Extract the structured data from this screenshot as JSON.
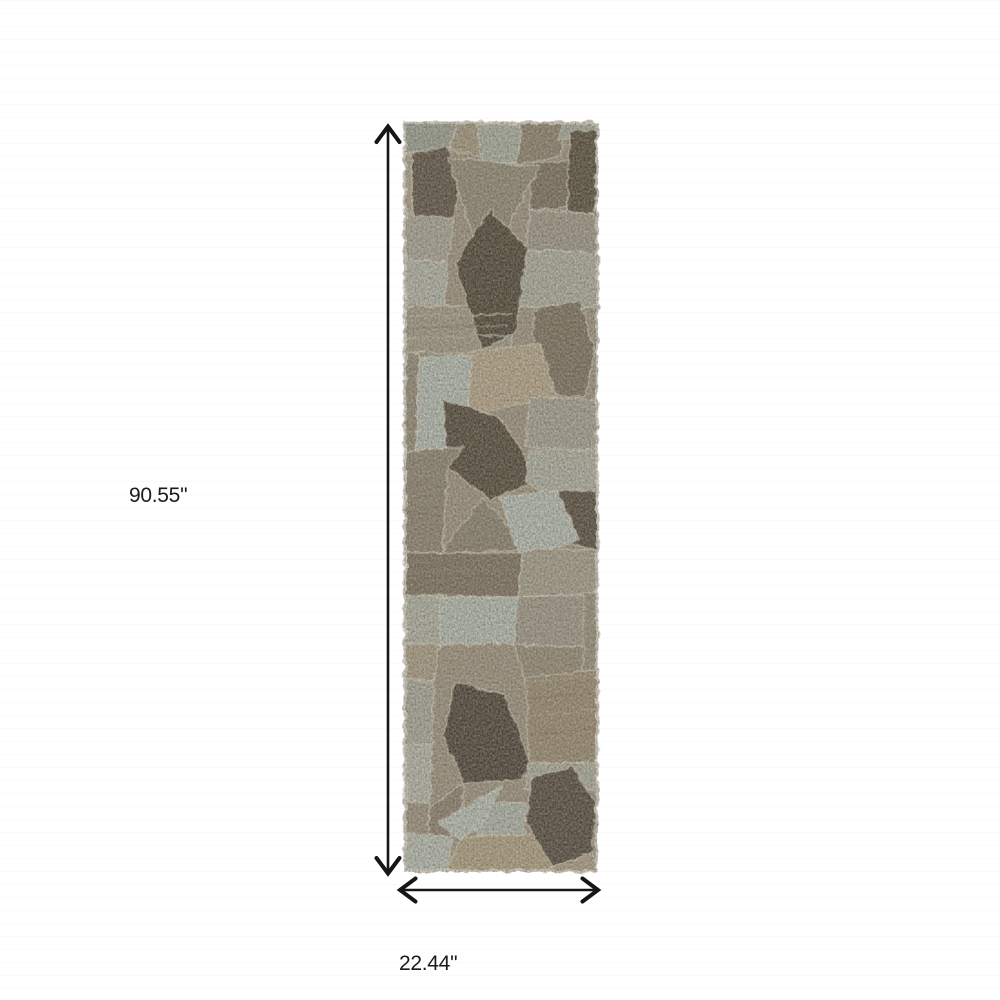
{
  "page": {
    "background_color": "#ffffff"
  },
  "dimensions": {
    "height_label": "90.55''",
    "width_label": "22.44''",
    "arrow_color": "#161616",
    "label_color": "#1b1b1b"
  },
  "rug": {
    "x": 404,
    "y": 122,
    "width": 194,
    "height": 750,
    "base_color": "#9d9381",
    "seam_color": "#d8d2c1",
    "edge_color": "#d3cec3",
    "palette": {
      "sage": "#b3bcb3",
      "taupe": "#a1987f",
      "gray": "#9c9889",
      "tan": "#b4a68c",
      "brown": "#7c7260",
      "dark_brown": "#4f4839"
    },
    "shapes": [
      {
        "points": "0,0 54,0 46,26 0,32",
        "fill": "#99a094"
      },
      {
        "points": "46,26 54,0 122,0 118,42 50,30",
        "fill": "#a1987f"
      },
      {
        "points": "74,2 118,2 115,40 77,44",
        "fill": "#a7aea1"
      },
      {
        "points": "118,0 162,0 157,34 114,42",
        "fill": "#8d8270"
      },
      {
        "points": "157,0 194,0 194,16 155,18",
        "fill": "#a3aa9d"
      },
      {
        "points": "129,41 166,38 163,85 126,88",
        "fill": "#7b7160"
      },
      {
        "points": "166,10 193,8 191,92 163,90",
        "fill": "#57503f"
      },
      {
        "points": "8,32 42,24 56,48 50,96 22,112 8,88",
        "fill": "#5d5547"
      },
      {
        "points": "0,32 8,32 8,88 22,112 18,150 0,148",
        "fill": "#a89f8c"
      },
      {
        "points": "0,92 50,96 44,140 0,138",
        "fill": "#a7a496"
      },
      {
        "points": "0,138 44,140 40,186 0,184",
        "fill": "#b0b3a8"
      },
      {
        "points": "44,35 136,45 79,148",
        "fill": "#8f8a77"
      },
      {
        "points": "126,88 191,92 194,132 121,128",
        "fill": "#9c9889"
      },
      {
        "points": "121,128 194,132 194,186 112,184",
        "fill": "#aaad9f"
      },
      {
        "points": "0,184 112,184 106,232 0,230",
        "fill": "#9f9988"
      },
      {
        "points": "86,88 123,126 112,210 78,228 51,140",
        "fill": "#4f4839"
      },
      {
        "points": "0,230 16,232 12,328 0,330",
        "fill": "#928a79"
      },
      {
        "points": "129,188 176,178 191,228 181,275 131,272",
        "fill": "#7c7260"
      },
      {
        "points": "53,231 136,222 152,275 66,293",
        "fill": "#b4a68c"
      },
      {
        "points": "16,235 68,233 60,325 12,328",
        "fill": "#b3bcb3"
      },
      {
        "points": "126,275 194,278 194,328 121,325",
        "fill": "#a4a193"
      },
      {
        "points": "39,278 96,296 136,358 86,378 44,345",
        "fill": "#534b3c"
      },
      {
        "points": "126,328 194,328 194,370 139,370 121,360",
        "fill": "#adb0a3"
      },
      {
        "points": "0,330 60,325 44,345 38,431 0,431",
        "fill": "#8c8373"
      },
      {
        "points": "139,368 194,368 194,428 160,421",
        "fill": "#584f41"
      },
      {
        "points": "79,376 126,428 36,431",
        "fill": "#8b8270"
      },
      {
        "points": "96,375 153,368 176,418 116,438",
        "fill": "#b4bdb5"
      },
      {
        "points": "0,431 119,431 114,475 0,473",
        "fill": "#7d7363"
      },
      {
        "points": "119,428 194,428 194,471 114,475",
        "fill": "#a49e8d"
      },
      {
        "points": "36,475 119,475 114,521 36,523",
        "fill": "#b2bbb2"
      },
      {
        "points": "114,475 183,473 180,525 110,523",
        "fill": "#9d998a"
      },
      {
        "points": "180,471 194,471 194,548 178,548",
        "fill": "#97907e"
      },
      {
        "points": "0,473 36,475 36,523 0,521",
        "fill": "#aeb1a4"
      },
      {
        "points": "0,521 36,523 30,558 0,558",
        "fill": "#a89d87"
      },
      {
        "points": "110,523 180,525 178,560 121,558",
        "fill": "#958c78"
      },
      {
        "points": "121,556 194,548 194,641 126,641",
        "fill": "#998c74"
      },
      {
        "points": "0,558 30,558 28,622 0,622",
        "fill": "#a5a89b"
      },
      {
        "points": "0,622 28,622 26,680 0,680",
        "fill": "#b3b6ab"
      },
      {
        "points": "50,560 100,572 126,640 118,658 60,661 40,615",
        "fill": "#4c453a"
      },
      {
        "points": "126,641 194,641 194,668 120,666",
        "fill": "#a9ac9e"
      },
      {
        "points": "75,682 122,680 120,712 73,714",
        "fill": "#adb4aa"
      },
      {
        "points": "0,680 26,680 24,714 0,714",
        "fill": "#9c9180"
      },
      {
        "points": "26,685 60,661 56,714 24,714",
        "fill": "#8a8070"
      },
      {
        "points": "34,700 98,664 78,704 56,718",
        "fill": "#b6bfb6"
      },
      {
        "points": "0,712 48,714 45,748 0,748",
        "fill": "#b5bcb2"
      },
      {
        "points": "56,716 150,710 152,748 44,748",
        "fill": "#aca084"
      },
      {
        "points": "128,656 168,645 192,682 188,730 148,745 122,700",
        "fill": "#544c40"
      },
      {
        "points": "148,745 188,730 194,750 140,750",
        "fill": "#a99e86"
      }
    ],
    "streaks": [
      {
        "x1": 2,
        "y1": 194,
        "x2": 108,
        "y2": 192,
        "color": "#b3ad9b",
        "w": 2
      },
      {
        "x1": 2,
        "y1": 206,
        "x2": 104,
        "y2": 204,
        "color": "#8b8575",
        "w": 2
      },
      {
        "x1": 2,
        "y1": 216,
        "x2": 100,
        "y2": 214,
        "color": "#b3ad9b",
        "w": 2
      },
      {
        "x1": 128,
        "y1": 576,
        "x2": 192,
        "y2": 570,
        "color": "#877a63",
        "w": 2
      },
      {
        "x1": 128,
        "y1": 594,
        "x2": 192,
        "y2": 588,
        "color": "#a89b82",
        "w": 2
      },
      {
        "x1": 128,
        "y1": 612,
        "x2": 192,
        "y2": 606,
        "color": "#877a63",
        "w": 2
      },
      {
        "x1": 2,
        "y1": 352,
        "x2": 36,
        "y2": 354,
        "color": "#9a917f",
        "w": 2
      },
      {
        "x1": 2,
        "y1": 392,
        "x2": 34,
        "y2": 394,
        "color": "#7f7666",
        "w": 2
      },
      {
        "x1": 2,
        "y1": 450,
        "x2": 112,
        "y2": 448,
        "color": "#8a7f6e",
        "w": 2
      },
      {
        "x1": 124,
        "y1": 560,
        "x2": 190,
        "y2": 554,
        "color": "#a89b82",
        "w": 2
      }
    ]
  }
}
